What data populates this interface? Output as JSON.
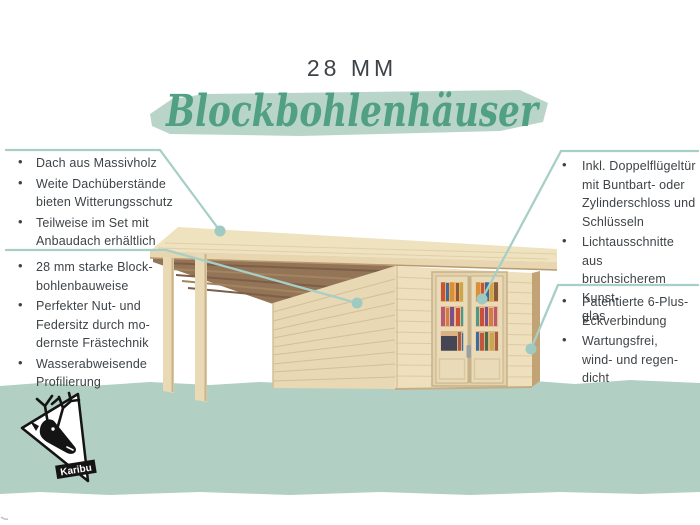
{
  "header": {
    "size_label": "28 MM",
    "script_title": "Blockbohlenhäuser"
  },
  "features_left": {
    "group1": {
      "items": [
        "Dach aus Massivholz",
        "Weite Dachüberstände\nbieten Witterungsschutz",
        "Teilweise im Set mit\nAnbaudach erhältlich"
      ]
    },
    "group2": {
      "items": [
        "28 mm starke Block-\nbohlenbauweise",
        "Perfekter Nut- und\nFedersitz durch mo-\ndernste Frästechnik",
        "Wasserabweisende\nProfilierung"
      ]
    }
  },
  "features_right": {
    "group1": {
      "items": [
        "Inkl. Doppelflügeltür\nmit Buntbart- oder\nZylinderschloss und\nSchlüsseln",
        "Lichtausschnitte aus\nbruchsicherem Kunst-\nglas"
      ]
    },
    "group2": {
      "items": [
        "Patentierte 6-Plus-\nEckverbindung",
        "Wartungsfrei,\nwind- und regen-\ndicht"
      ]
    }
  },
  "logo": {
    "brand": "Karibu"
  },
  "colors": {
    "accent_script": "#51a083",
    "brush_background": "#b9d5c9",
    "leader_line": "#a7cfc7",
    "callout_dot": "#9ecac2",
    "ground_green": "#b1cfc2",
    "body_text": "#3e4347",
    "wood_light": "#eee0bd",
    "wood_shadow": "#937456"
  }
}
